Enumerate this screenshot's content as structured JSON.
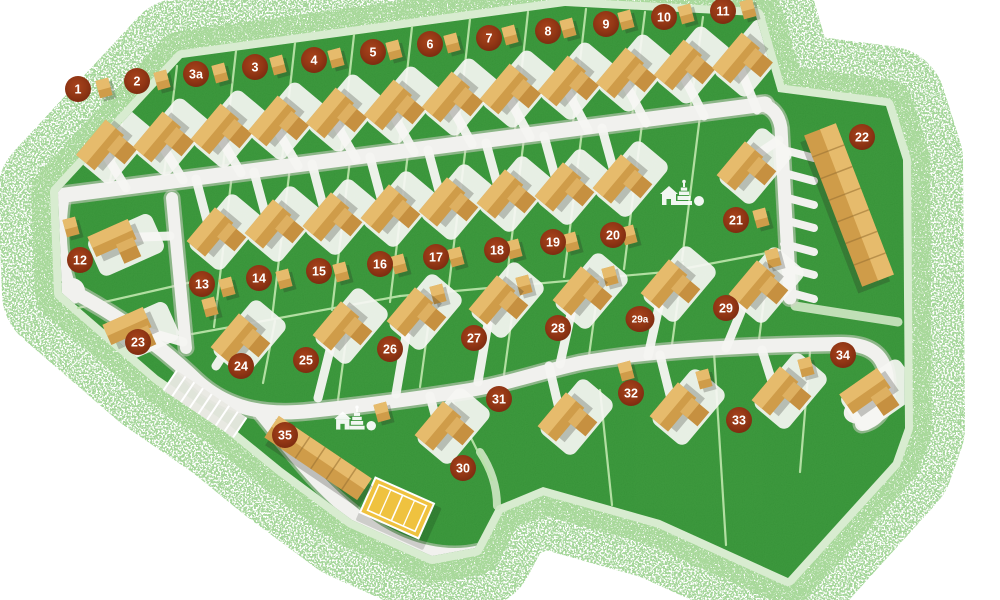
{
  "map": {
    "width": 1000,
    "height": 600,
    "colors": {
      "background": "#ffffff",
      "grass": "#3f9d40",
      "grain": "#1e6b1e",
      "spray_outer": "#8fcd81",
      "spray_inner": "#a9d99b",
      "rim": "#d8ecd0",
      "divider": "#b9e3a8",
      "pale_path": "#cfe7c4",
      "road": "#f1f1ee",
      "road_casing": "#cfcfc7",
      "house_light": "#e6bb6c",
      "house_mid": "#cf9c49",
      "house_dark": "#c69040",
      "building_line": "#9c7435",
      "shadow": "rgba(40,40,30,0.25)",
      "pad": "#f6f6f3",
      "badge_center": "#a8431c",
      "badge_mid": "#933715",
      "badge_edge": "#7a2a0f",
      "badge_text": "#ffffff",
      "court": "#efc23f",
      "court_line": "#ffffff",
      "parking_fill": "#e9e9e3",
      "icon": "#ffffff"
    },
    "park_outline": "M58,192 L182,58 L565,6 L756,16 L778,92 L886,106 L903,160 L905,428 L893,462 L788,578 L660,520 L543,487 L497,506 L475,548 L432,556 L352,520 L282,468 L228,424 L158,376 L62,293 Z",
    "badges": [
      {
        "label": "1",
        "x": 78,
        "y": 89
      },
      {
        "label": "2",
        "x": 137,
        "y": 81
      },
      {
        "label": "3a",
        "x": 196,
        "y": 74
      },
      {
        "label": "3",
        "x": 255,
        "y": 67
      },
      {
        "label": "4",
        "x": 314,
        "y": 60
      },
      {
        "label": "5",
        "x": 373,
        "y": 52
      },
      {
        "label": "6",
        "x": 430,
        "y": 44
      },
      {
        "label": "7",
        "x": 489,
        "y": 38
      },
      {
        "label": "8",
        "x": 548,
        "y": 31
      },
      {
        "label": "9",
        "x": 606,
        "y": 24
      },
      {
        "label": "10",
        "x": 664,
        "y": 17
      },
      {
        "label": "11",
        "x": 723,
        "y": 11
      },
      {
        "label": "12",
        "x": 80,
        "y": 260
      },
      {
        "label": "13",
        "x": 202,
        "y": 284
      },
      {
        "label": "14",
        "x": 259,
        "y": 278
      },
      {
        "label": "15",
        "x": 319,
        "y": 271
      },
      {
        "label": "16",
        "x": 380,
        "y": 264
      },
      {
        "label": "17",
        "x": 436,
        "y": 257
      },
      {
        "label": "18",
        "x": 497,
        "y": 250
      },
      {
        "label": "19",
        "x": 553,
        "y": 242
      },
      {
        "label": "20",
        "x": 613,
        "y": 235
      },
      {
        "label": "21",
        "x": 736,
        "y": 220
      },
      {
        "label": "22",
        "x": 862,
        "y": 137
      },
      {
        "label": "23",
        "x": 138,
        "y": 342
      },
      {
        "label": "24",
        "x": 241,
        "y": 366
      },
      {
        "label": "25",
        "x": 306,
        "y": 360
      },
      {
        "label": "26",
        "x": 390,
        "y": 349
      },
      {
        "label": "27",
        "x": 474,
        "y": 338
      },
      {
        "label": "28",
        "x": 558,
        "y": 328
      },
      {
        "label": "29a",
        "x": 640,
        "y": 319
      },
      {
        "label": "29",
        "x": 726,
        "y": 308
      },
      {
        "label": "30",
        "x": 463,
        "y": 468
      },
      {
        "label": "31",
        "x": 499,
        "y": 399
      },
      {
        "label": "32",
        "x": 631,
        "y": 393
      },
      {
        "label": "33",
        "x": 739,
        "y": 420
      },
      {
        "label": "34",
        "x": 843,
        "y": 355
      },
      {
        "label": "35",
        "x": 285,
        "y": 435
      }
    ],
    "roads": [
      {
        "d": "M58,196 L765,104",
        "w": 15
      },
      {
        "d": "M760,104 Q778,108 781,128 L790,298",
        "w": 13
      },
      {
        "d": "M172,198 L186,348",
        "w": 12
      },
      {
        "d": "M63,200 Q56,250 71,290",
        "w": 12,
        "bulb": [
          72,
          291,
          13
        ]
      },
      {
        "d": "M72,291 C130,322 170,355 196,380 C226,408 262,416 310,411 C360,406 420,398 470,390 C510,383 540,372 580,363 C640,352 720,346 838,344 C872,343 886,356 887,382 C888,404 880,420 862,424",
        "w": 14
      },
      {
        "d": "M262,414 C290,448 320,492 372,528 C408,552 448,560 480,552",
        "w": 14
      }
    ],
    "terrace_drives": [
      [
        784,
        150,
        814,
        158
      ],
      [
        784,
        173,
        814,
        181
      ],
      [
        784,
        197,
        814,
        205
      ],
      [
        784,
        220,
        814,
        228
      ],
      [
        784,
        244,
        814,
        252
      ],
      [
        784,
        267,
        814,
        275
      ],
      [
        784,
        291,
        814,
        299
      ]
    ],
    "pale_paths": [
      {
        "d": "M795,306 L898,322",
        "w": 9
      },
      {
        "d": "M480,452 C492,470 497,488 497,506",
        "w": 8
      }
    ],
    "dividers": [
      [
        108,
        190,
        122,
        123
      ],
      [
        163,
        183,
        177,
        66
      ],
      [
        222,
        176,
        236,
        51
      ],
      [
        281,
        168,
        295,
        43
      ],
      [
        340,
        161,
        354,
        35
      ],
      [
        398,
        154,
        412,
        27
      ],
      [
        456,
        147,
        470,
        19
      ],
      [
        514,
        139,
        528,
        12
      ],
      [
        572,
        132,
        586,
        9
      ],
      [
        631,
        125,
        645,
        12
      ],
      [
        689,
        118,
        703,
        17
      ],
      [
        232,
        174,
        214,
        327
      ],
      [
        290,
        167,
        272,
        318
      ],
      [
        350,
        160,
        332,
        310
      ],
      [
        408,
        153,
        390,
        302
      ],
      [
        466,
        145,
        448,
        293
      ],
      [
        524,
        138,
        506,
        285
      ],
      [
        582,
        131,
        564,
        277
      ],
      [
        642,
        124,
        624,
        269
      ],
      [
        700,
        116,
        682,
        260
      ],
      [
        192,
        334,
        400,
        296
      ],
      [
        400,
        296,
        666,
        272
      ],
      [
        666,
        272,
        788,
        249
      ],
      [
        275,
        321,
        263,
        383
      ],
      [
        350,
        310,
        338,
        400
      ],
      [
        432,
        298,
        420,
        387
      ],
      [
        516,
        287,
        504,
        375
      ],
      [
        600,
        275,
        588,
        363
      ],
      [
        683,
        263,
        671,
        352
      ],
      [
        770,
        251,
        758,
        348
      ],
      [
        78,
        308,
        192,
        282
      ],
      [
        447,
        390,
        492,
        480
      ],
      [
        600,
        390,
        612,
        505
      ],
      [
        714,
        352,
        726,
        545
      ],
      [
        810,
        352,
        800,
        472
      ]
    ],
    "houses": [
      {
        "id": "1",
        "x": 100,
        "y": 145,
        "rot": -50,
        "w": 46,
        "h": 24,
        "sx": 126,
        "sy": 188
      },
      {
        "id": "2",
        "x": 157,
        "y": 137,
        "rot": -50,
        "w": 46,
        "h": 24,
        "sx": 183,
        "sy": 180
      },
      {
        "id": "3a",
        "x": 215,
        "y": 129,
        "rot": -50,
        "w": 46,
        "h": 24,
        "sx": 241,
        "sy": 173
      },
      {
        "id": "3",
        "x": 272,
        "y": 121,
        "rot": -50,
        "w": 46,
        "h": 24,
        "sx": 298,
        "sy": 166
      },
      {
        "id": "4",
        "x": 330,
        "y": 113,
        "rot": -50,
        "w": 46,
        "h": 24,
        "sx": 356,
        "sy": 159
      },
      {
        "id": "5",
        "x": 388,
        "y": 105,
        "rot": -50,
        "w": 46,
        "h": 24,
        "sx": 414,
        "sy": 152
      },
      {
        "id": "6",
        "x": 446,
        "y": 97,
        "rot": -50,
        "w": 46,
        "h": 24,
        "sx": 472,
        "sy": 144
      },
      {
        "id": "7",
        "x": 504,
        "y": 89,
        "rot": -50,
        "w": 46,
        "h": 24,
        "sx": 530,
        "sy": 137
      },
      {
        "id": "8",
        "x": 562,
        "y": 81,
        "rot": -50,
        "w": 46,
        "h": 24,
        "sx": 588,
        "sy": 130
      },
      {
        "id": "9",
        "x": 620,
        "y": 73,
        "rot": -50,
        "w": 46,
        "h": 24,
        "sx": 646,
        "sy": 123
      },
      {
        "id": "10",
        "x": 678,
        "y": 65,
        "rot": -50,
        "w": 46,
        "h": 24,
        "sx": 704,
        "sy": 116
      },
      {
        "id": "11",
        "x": 736,
        "y": 58,
        "rot": -50,
        "w": 46,
        "h": 24,
        "sx": 757,
        "sy": 110
      },
      {
        "id": "13",
        "x": 210,
        "y": 232,
        "rot": -50,
        "w": 44,
        "h": 24,
        "sx": 196,
        "sy": 179
      },
      {
        "id": "14",
        "x": 268,
        "y": 224,
        "rot": -50,
        "w": 44,
        "h": 24,
        "sx": 254,
        "sy": 172
      },
      {
        "id": "15",
        "x": 326,
        "y": 217,
        "rot": -50,
        "w": 44,
        "h": 24,
        "sx": 312,
        "sy": 164
      },
      {
        "id": "16",
        "x": 384,
        "y": 209,
        "rot": -50,
        "w": 44,
        "h": 24,
        "sx": 370,
        "sy": 157
      },
      {
        "id": "17",
        "x": 442,
        "y": 202,
        "rot": -50,
        "w": 44,
        "h": 24,
        "sx": 428,
        "sy": 150
      },
      {
        "id": "18",
        "x": 500,
        "y": 194,
        "rot": -50,
        "w": 44,
        "h": 24,
        "sx": 486,
        "sy": 143
      },
      {
        "id": "19",
        "x": 558,
        "y": 187,
        "rot": -50,
        "w": 44,
        "h": 24,
        "sx": 544,
        "sy": 136
      },
      {
        "id": "20",
        "x": 616,
        "y": 179,
        "rot": -50,
        "w": 44,
        "h": 24,
        "sx": 602,
        "sy": 128
      },
      {
        "id": "21",
        "x": 740,
        "y": 166,
        "rot": -50,
        "w": 44,
        "h": 24,
        "sx": 779,
        "sy": 140
      },
      {
        "id": "12",
        "x": 112,
        "y": 238,
        "rot": -24,
        "w": 44,
        "h": 22,
        "sx": 170,
        "sy": 236
      },
      {
        "id": "23",
        "x": 127,
        "y": 326,
        "rot": -24,
        "w": 44,
        "h": 22,
        "sx": 183,
        "sy": 342
      },
      {
        "id": "24",
        "x": 234,
        "y": 338,
        "rot": -50,
        "w": 44,
        "h": 24,
        "sx": 216,
        "sy": 366
      },
      {
        "id": "25",
        "x": 336,
        "y": 326,
        "rot": -50,
        "w": 44,
        "h": 24,
        "sx": 318,
        "sy": 398
      },
      {
        "id": "26",
        "x": 410,
        "y": 312,
        "rot": -50,
        "w": 44,
        "h": 24,
        "sx": 396,
        "sy": 394
      },
      {
        "id": "27",
        "x": 492,
        "y": 300,
        "rot": -50,
        "w": 44,
        "h": 24,
        "sx": 478,
        "sy": 382
      },
      {
        "id": "28",
        "x": 576,
        "y": 291,
        "rot": -50,
        "w": 44,
        "h": 24,
        "sx": 560,
        "sy": 364
      },
      {
        "id": "29a",
        "x": 664,
        "y": 284,
        "rot": -50,
        "w": 44,
        "h": 24,
        "sx": 648,
        "sy": 356
      },
      {
        "id": "29",
        "x": 752,
        "y": 285,
        "rot": -50,
        "w": 44,
        "h": 24,
        "sx": 726,
        "sy": 348
      },
      {
        "id": "30",
        "x": 438,
        "y": 426,
        "rot": -50,
        "w": 44,
        "h": 24,
        "sx": 430,
        "sy": 396
      },
      {
        "id": "31",
        "x": 561,
        "y": 417,
        "rot": -50,
        "w": 44,
        "h": 24,
        "sx": 549,
        "sy": 366
      },
      {
        "id": "32",
        "x": 673,
        "y": 407,
        "rot": -50,
        "w": 44,
        "h": 24,
        "sx": 660,
        "sy": 355
      },
      {
        "id": "33",
        "x": 775,
        "y": 391,
        "rot": -50,
        "w": 44,
        "h": 24,
        "sx": 762,
        "sy": 350
      },
      {
        "id": "34",
        "x": 865,
        "y": 391,
        "rot": -35,
        "w": 46,
        "h": 24
      }
    ],
    "sheds": [
      [
        104,
        88
      ],
      [
        162,
        80
      ],
      [
        220,
        73
      ],
      [
        278,
        65
      ],
      [
        336,
        58
      ],
      [
        394,
        50
      ],
      [
        452,
        43
      ],
      [
        510,
        35
      ],
      [
        568,
        28
      ],
      [
        626,
        20
      ],
      [
        686,
        14
      ],
      [
        748,
        9
      ],
      [
        227,
        287
      ],
      [
        284,
        279
      ],
      [
        341,
        272
      ],
      [
        399,
        264
      ],
      [
        456,
        257
      ],
      [
        514,
        249
      ],
      [
        571,
        242
      ],
      [
        629,
        235
      ],
      [
        761,
        218
      ],
      [
        71,
        227
      ],
      [
        210,
        307
      ],
      [
        438,
        294
      ],
      [
        524,
        285
      ],
      [
        610,
        276
      ],
      [
        773,
        258
      ],
      [
        382,
        412
      ],
      [
        626,
        371
      ],
      [
        704,
        379
      ],
      [
        806,
        367
      ]
    ],
    "terrace": {
      "x": 849,
      "y": 205,
      "rot": 69,
      "w": 162,
      "h": 34,
      "units": 7
    },
    "garages": {
      "x": 318,
      "y": 458,
      "rot": 34,
      "w": 112,
      "h": 26,
      "units": 6
    },
    "tennis_court": {
      "x": 397,
      "y": 508,
      "rot": 24,
      "w": 64,
      "h": 38
    },
    "parking": {
      "x": 205,
      "y": 404,
      "rot": 34,
      "w": 84,
      "h": 24,
      "bays": 8
    },
    "loop_pad": {
      "x": 868,
      "y": 408,
      "rx": 25,
      "ry": 15,
      "rot": -18
    },
    "playgrounds": [
      {
        "x": 684,
        "y": 196,
        "scale": 1.0
      },
      {
        "x": 357,
        "y": 421,
        "scale": 0.95
      }
    ]
  }
}
